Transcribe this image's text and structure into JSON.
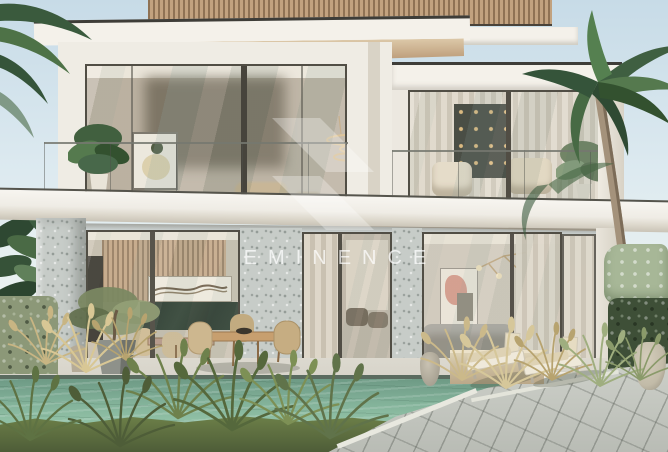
{
  "watermark": {
    "brand": "EMINENCE",
    "logo": "double-chevron-emblem"
  },
  "colors": {
    "sky-top": "#c7dbe7",
    "sky-mid": "#ddeaf0",
    "sky-low": "#eef4f1",
    "roof-edge": "#3e3d38",
    "fascia": "#f4f1ea",
    "soffit-light": "#dcc8a8",
    "soffit-dark": "#b5926f",
    "slat-light": "#c2a27f",
    "slat-dark": "#8f7254",
    "wall": "#efece4",
    "wall-shade": "#d9d3c6",
    "glass-warm": "#b3a896",
    "terrazzo": "#c7ccc8",
    "curtain": "#ded7c9",
    "curtain-shade": "#c9c1b1",
    "marble-green": "#243226",
    "wood-interior": "#b8946b",
    "pool-edge": "#5a6b5f",
    "pool-deep": "#6e9a85",
    "pool-shallow": "#9ccab0",
    "terrace": "#d3d0c6",
    "paver": "#c3c6bf",
    "grass-light": "#6e8149",
    "grass-dark": "#4e5d38",
    "hedge-left": "#8c9878",
    "hedge-right": "#3e4f37",
    "shrub-light": "#a7b797",
    "palm-dark": "#35543a",
    "palm-light": "#558050",
    "trunk": "#a4927b",
    "cushion": "#ded2b4",
    "lounger-frame": "#efe9da",
    "planter": "#d0c2a4",
    "pot-gray": "#8e918a",
    "jar": "#c2bba8",
    "art-pink": "#d29a8a",
    "brass": "#d8b476",
    "watermark": "rgba(255,255,255,0.72)",
    "watermark-logo": "rgba(255,255,255,0.30)"
  },
  "scene": {
    "type": "architectural-render",
    "elements": [
      "sky",
      "palm-trees",
      "two-storey-villa",
      "wood-slat-parapet",
      "roof-overhang",
      "upper-balcony-left",
      "upper-balcony-right",
      "glass-railing",
      "pendant-chandelier",
      "wall-art",
      "sheer-curtains",
      "terrazzo-columns",
      "kitchen-dining-interior",
      "living-room-interior",
      "swimming-pool",
      "pool-steps",
      "sun-loungers",
      "outdoor-dining-set",
      "olive-tree-planter",
      "ornamental-grasses",
      "hedges",
      "stone-paver-path",
      "lawn",
      "amphora-jar",
      "watermark-logo",
      "watermark-text"
    ]
  }
}
